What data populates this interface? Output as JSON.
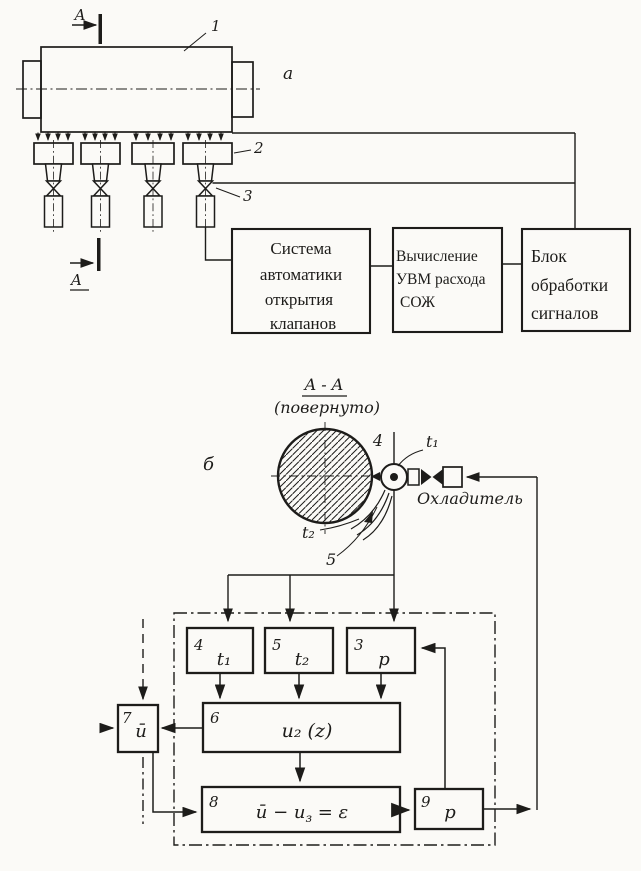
{
  "colors": {
    "paper": "#fbfaf7",
    "ink": "#1d1c1a"
  },
  "section_a": {
    "label": "a",
    "section_marks": {
      "top": "A",
      "bottom": "A"
    },
    "callouts": {
      "machine": "1",
      "manifold": "2",
      "valve": "3"
    },
    "flow_blocks": [
      {
        "id": "valve-automation-system",
        "lines": [
          "Система",
          "автоматики",
          "открытия",
          "клапанов"
        ]
      },
      {
        "id": "uvm-flow-computation",
        "lines": [
          "Вычисление",
          "УВМ расхода",
          "СОЖ"
        ]
      },
      {
        "id": "signal-processing-unit",
        "lines": [
          "Блок",
          "обработки",
          "сигналов"
        ]
      }
    ]
  },
  "section_b": {
    "label": "б",
    "view": {
      "title": "A - A",
      "subtitle": "(повернуто)"
    },
    "labels": {
      "coolant": "Охладитель",
      "t1": "t₁",
      "t2": "t₂",
      "nozzle_callout": "4",
      "streams_callout": "5"
    },
    "blocks": {
      "b4": {
        "num": "4",
        "text": "t₁"
      },
      "b5": {
        "num": "5",
        "text": "t₂"
      },
      "b3": {
        "num": "3",
        "text": "p"
      },
      "b6": {
        "num": "6",
        "text": "u₂ (z)"
      },
      "b7": {
        "num": "7",
        "text": "ū"
      },
      "b8": {
        "num": "8",
        "pre": "ū − u",
        "sub": "з",
        "post": " = ε"
      },
      "b9": {
        "num": "9",
        "text": "p"
      }
    }
  }
}
